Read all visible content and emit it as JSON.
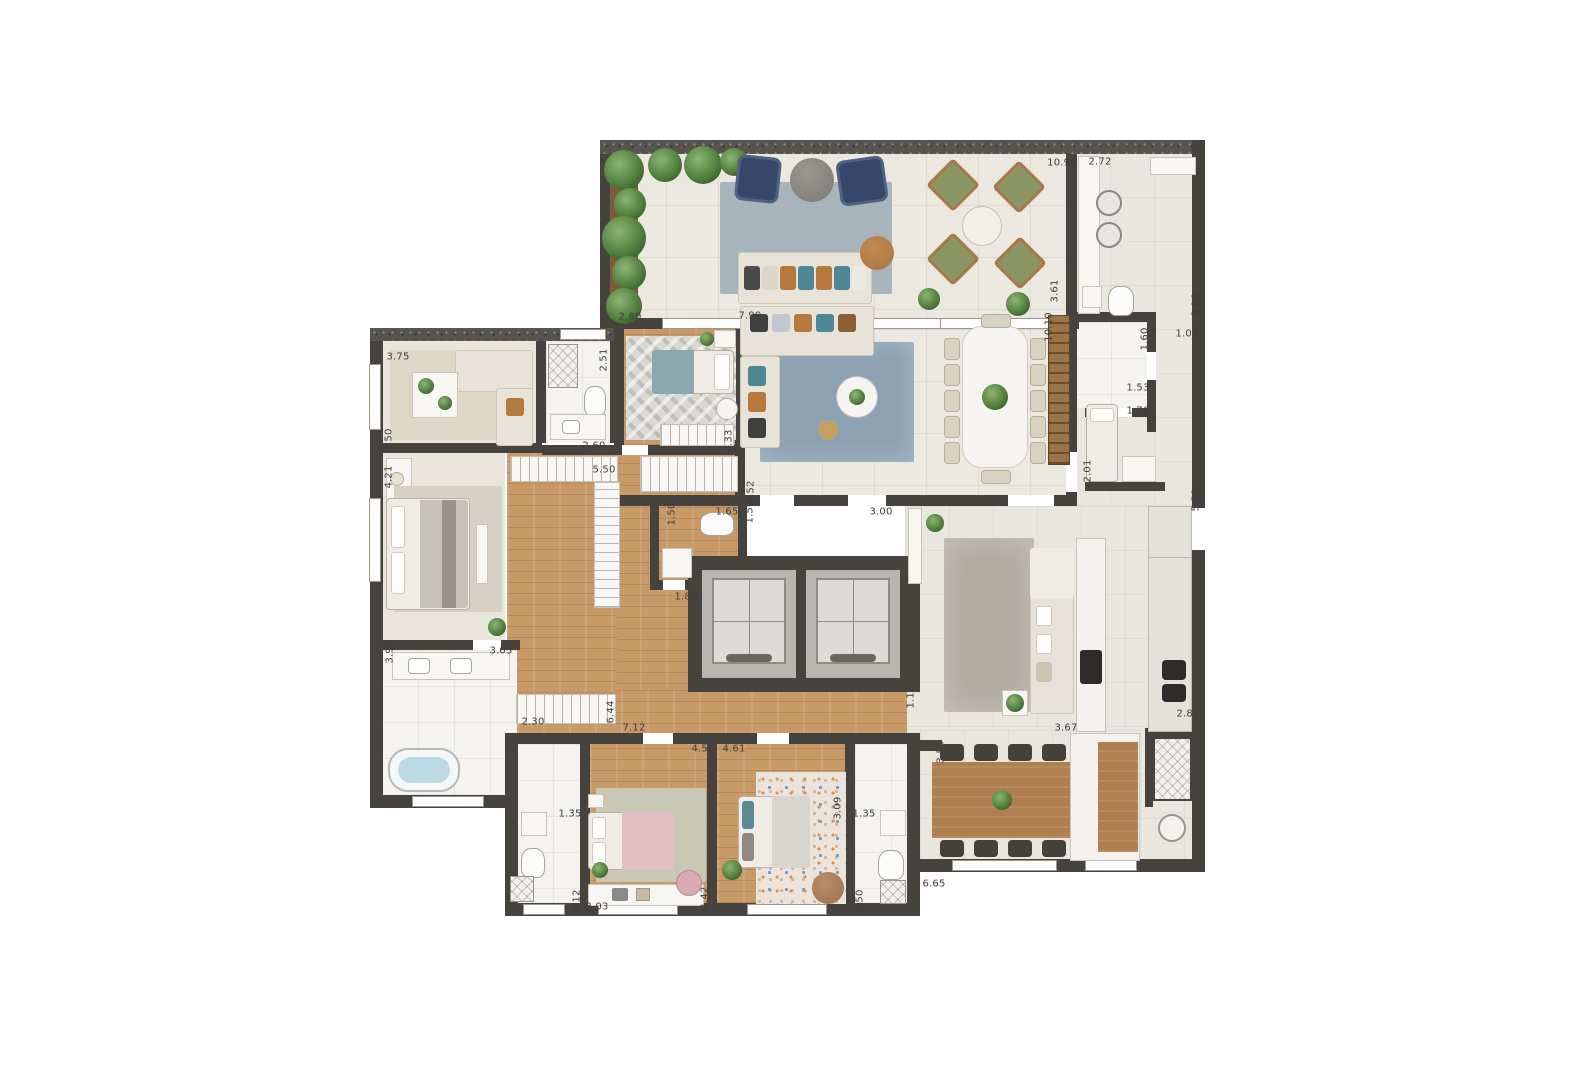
{
  "title": "apartment-floor-plan",
  "colors": {
    "wall": "#46423e",
    "exterior_wall": "#57544f",
    "wood_floor": "#c89a68",
    "tile_floor": "#ebe8e0",
    "marble_floor": "#f4f3f0",
    "living_rug": "#8ca2b2",
    "terrace_rug": "#a7b4bc",
    "navy_armchair": "#35476b",
    "green_armchair": "#8a9663",
    "pink_bed": "#e2bec5",
    "teal_accent": "#4f8794",
    "dimension_text": "#3e3e3e"
  },
  "dimensions": [
    {
      "value": "10.96",
      "x": 1062,
      "y": 163,
      "o": "h"
    },
    {
      "value": "2.72",
      "x": 1100,
      "y": 162,
      "o": "h"
    },
    {
      "value": "3.75",
      "x": 398,
      "y": 357,
      "o": "h"
    },
    {
      "value": "2.50",
      "x": 389,
      "y": 440,
      "o": "v"
    },
    {
      "value": "4.21",
      "x": 389,
      "y": 477,
      "o": "v"
    },
    {
      "value": "2.51",
      "x": 604,
      "y": 360,
      "o": "v"
    },
    {
      "value": "2.60",
      "x": 594,
      "y": 446,
      "o": "h"
    },
    {
      "value": "2.80",
      "x": 630,
      "y": 317,
      "o": "h"
    },
    {
      "value": "7.99",
      "x": 750,
      "y": 316,
      "o": "h"
    },
    {
      "value": "3.33",
      "x": 729,
      "y": 441,
      "o": "v"
    },
    {
      "value": "5.50",
      "x": 604,
      "y": 470,
      "o": "h"
    },
    {
      "value": "4.52",
      "x": 751,
      "y": 492,
      "o": "v"
    },
    {
      "value": "1.50",
      "x": 672,
      "y": 514,
      "o": "v"
    },
    {
      "value": "1.65",
      "x": 727,
      "y": 512,
      "o": "h"
    },
    {
      "value": "1.50",
      "x": 750,
      "y": 512,
      "o": "v"
    },
    {
      "value": "3.00",
      "x": 881,
      "y": 512,
      "o": "h"
    },
    {
      "value": "1.88",
      "x": 686,
      "y": 597,
      "o": "h"
    },
    {
      "value": "3.61",
      "x": 1055,
      "y": 291,
      "o": "v"
    },
    {
      "value": "10.10",
      "x": 1049,
      "y": 327,
      "o": "v"
    },
    {
      "value": "3.96",
      "x": 1196,
      "y": 305,
      "o": "v"
    },
    {
      "value": "1.05",
      "x": 1187,
      "y": 334,
      "o": "h"
    },
    {
      "value": "1.60",
      "x": 1145,
      "y": 339,
      "o": "v"
    },
    {
      "value": "1.53",
      "x": 1138,
      "y": 388,
      "o": "h"
    },
    {
      "value": "1.70",
      "x": 1138,
      "y": 411,
      "o": "h"
    },
    {
      "value": "2.01",
      "x": 1088,
      "y": 471,
      "o": "v"
    },
    {
      "value": "5.53",
      "x": 1196,
      "y": 500,
      "o": "v"
    },
    {
      "value": "3.90",
      "x": 390,
      "y": 652,
      "o": "v"
    },
    {
      "value": "3.03",
      "x": 501,
      "y": 651,
      "o": "h"
    },
    {
      "value": "2.30",
      "x": 533,
      "y": 722,
      "o": "h"
    },
    {
      "value": "6.44",
      "x": 611,
      "y": 712,
      "o": "v"
    },
    {
      "value": "7.12",
      "x": 634,
      "y": 728,
      "o": "h"
    },
    {
      "value": "4.55",
      "x": 703,
      "y": 749,
      "o": "h"
    },
    {
      "value": "4.61",
      "x": 734,
      "y": 749,
      "o": "h"
    },
    {
      "value": "1.10",
      "x": 911,
      "y": 697,
      "o": "v"
    },
    {
      "value": "3.55",
      "x": 941,
      "y": 752,
      "o": "v"
    },
    {
      "value": "3.67",
      "x": 1066,
      "y": 728,
      "o": "h"
    },
    {
      "value": "2.85",
      "x": 1188,
      "y": 714,
      "o": "h"
    },
    {
      "value": "1.35",
      "x": 570,
      "y": 814,
      "o": "h"
    },
    {
      "value": "4.12",
      "x": 577,
      "y": 901,
      "o": "v"
    },
    {
      "value": "3.03",
      "x": 597,
      "y": 907,
      "o": "h"
    },
    {
      "value": "4.42",
      "x": 705,
      "y": 898,
      "o": "v"
    },
    {
      "value": "3.09",
      "x": 838,
      "y": 808,
      "o": "v"
    },
    {
      "value": "1.35",
      "x": 864,
      "y": 814,
      "o": "h"
    },
    {
      "value": "2.50",
      "x": 860,
      "y": 901,
      "o": "v"
    },
    {
      "value": "6.65",
      "x": 934,
      "y": 884,
      "o": "h"
    }
  ]
}
